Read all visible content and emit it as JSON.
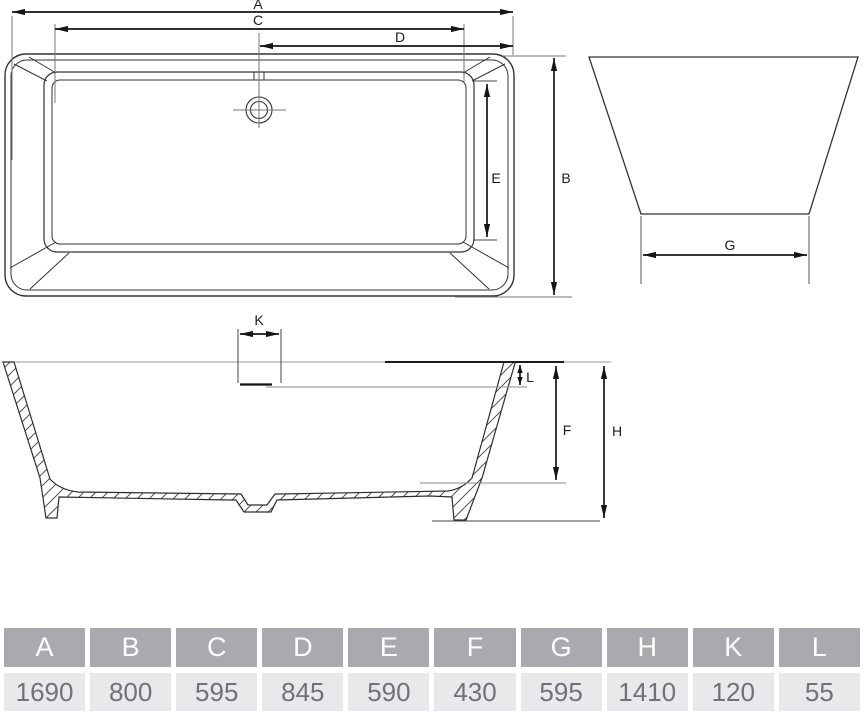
{
  "diagram": {
    "type": "bathtub technical dimension drawing",
    "labels": {
      "A": "A",
      "B": "B",
      "C": "C",
      "D": "D",
      "E": "E",
      "F": "F",
      "G": "G",
      "H": "H",
      "K": "K",
      "L": "L"
    }
  },
  "table": {
    "columns": [
      {
        "letter": "A",
        "value": "1690"
      },
      {
        "letter": "B",
        "value": "800"
      },
      {
        "letter": "C",
        "value": "595"
      },
      {
        "letter": "D",
        "value": "845"
      },
      {
        "letter": "E",
        "value": "590"
      },
      {
        "letter": "F",
        "value": "430"
      },
      {
        "letter": "G",
        "value": "595"
      },
      {
        "letter": "H",
        "value": "1410"
      },
      {
        "letter": "K",
        "value": "120"
      },
      {
        "letter": "L",
        "value": "55"
      }
    ]
  },
  "colors": {
    "header_bg": "#a8aaad",
    "header_text": "#ffffff",
    "value_bg": "#e9e9eb",
    "value_text": "#6f7276",
    "outline": "#333333",
    "dimension": "#151515",
    "reference": "#8a8a8a"
  }
}
